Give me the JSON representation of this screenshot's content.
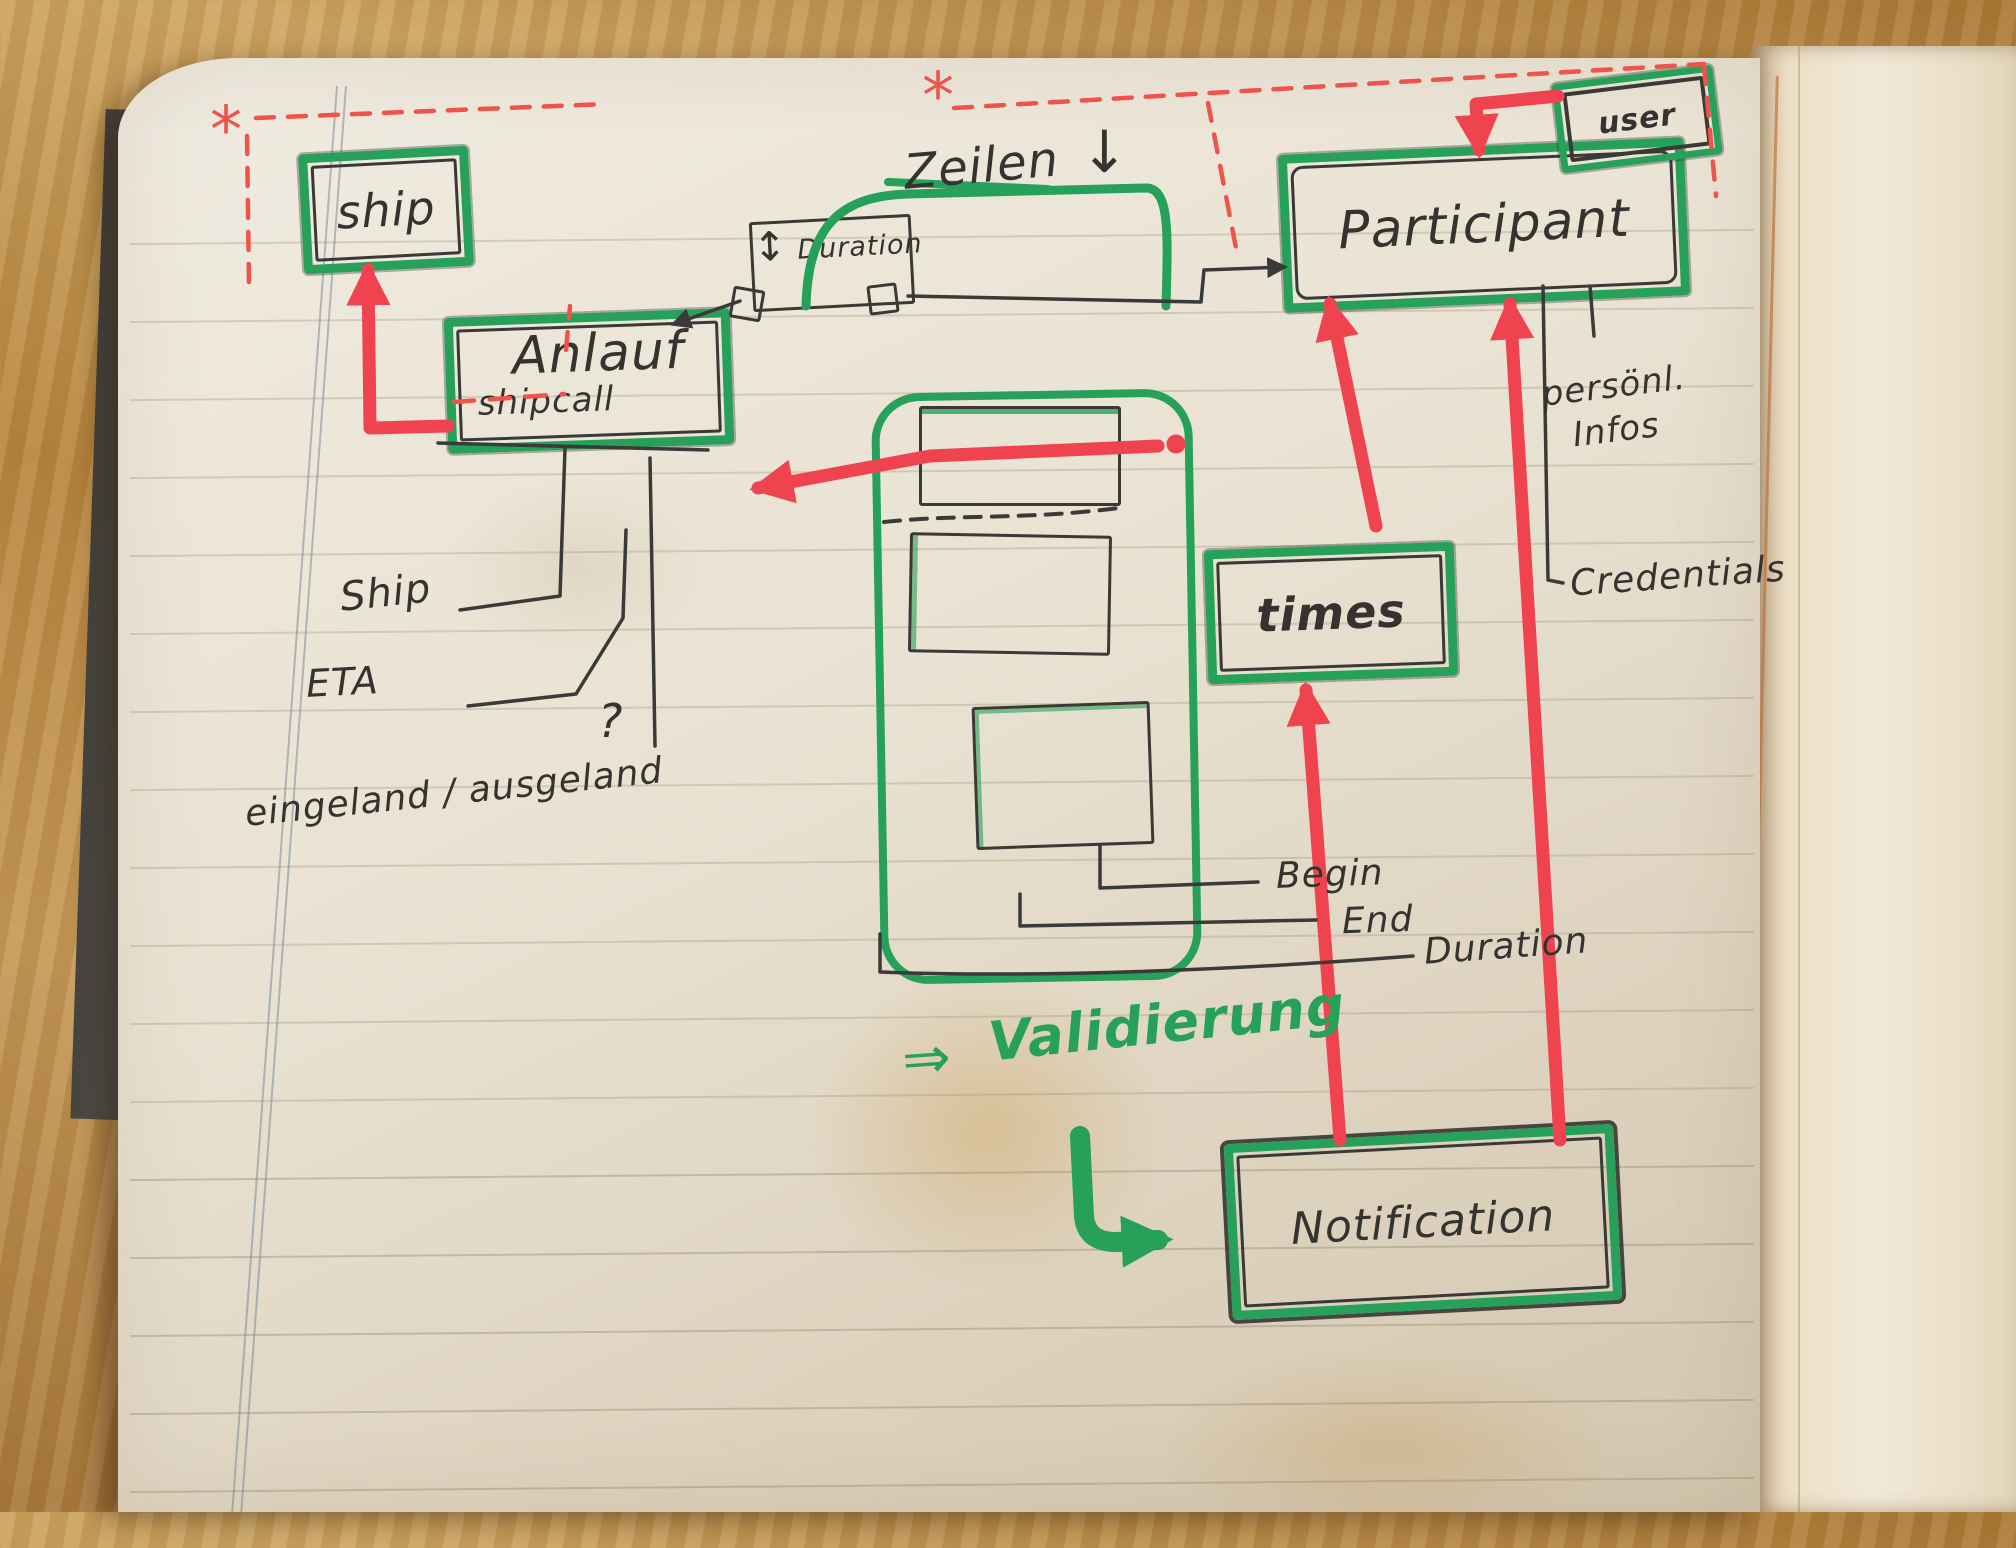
{
  "colors": {
    "green": "#27a05a",
    "red": "#ef4450",
    "red_dash": "#ef5349",
    "ink": "#35332f",
    "paper": "#eae4d6"
  },
  "boxes": {
    "ship": {
      "label": "ship"
    },
    "anlauf": {
      "label": "Anlauf",
      "sublabel": "shipcall"
    },
    "duration": {
      "label": "Duration",
      "resize_glyph": "↕"
    },
    "participant": {
      "label": "Participant"
    },
    "user": {
      "label": "user"
    },
    "times": {
      "label": "times"
    },
    "notification": {
      "label": "Notification"
    }
  },
  "annotations": {
    "asterisk": "*",
    "zeilen": {
      "label": "Zeilen",
      "arrow_glyph": "↓"
    },
    "ship_attr": "Ship",
    "eta_attr": "ETA",
    "inout_attr": "eingeland / ausgeland",
    "question_glyph": "?",
    "begin_attr": "Begin",
    "end_attr": "End",
    "duration_attr": "Duration",
    "personal_info_line1": "persönl.",
    "personal_info_line2": "Infos",
    "credentials_attr": "Credentials",
    "validation": {
      "arrow_glyph": "⇒",
      "label": "Validierung"
    }
  }
}
